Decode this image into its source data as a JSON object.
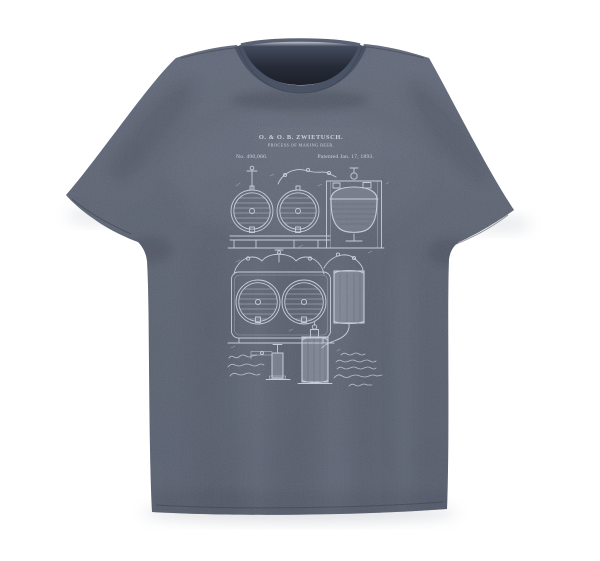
{
  "scene": {
    "background_color": "#ffffff",
    "shadow_color": "#9aa0ab"
  },
  "shirt": {
    "fabric_color": "#4f5769",
    "fabric_light": "#565e71",
    "collar_color": "#4a5365",
    "inner_neck_shadow": "#20242e"
  },
  "patent_print": {
    "ink_color": "#dce2ee",
    "header": {
      "inventor_line": "O. & O. B. ZWIETUSCH.",
      "title_line": "PROCESS OF MAKING BEER.",
      "patent_number": "No. 490,066.",
      "patent_date": "Patented Jan. 17, 1893."
    }
  }
}
